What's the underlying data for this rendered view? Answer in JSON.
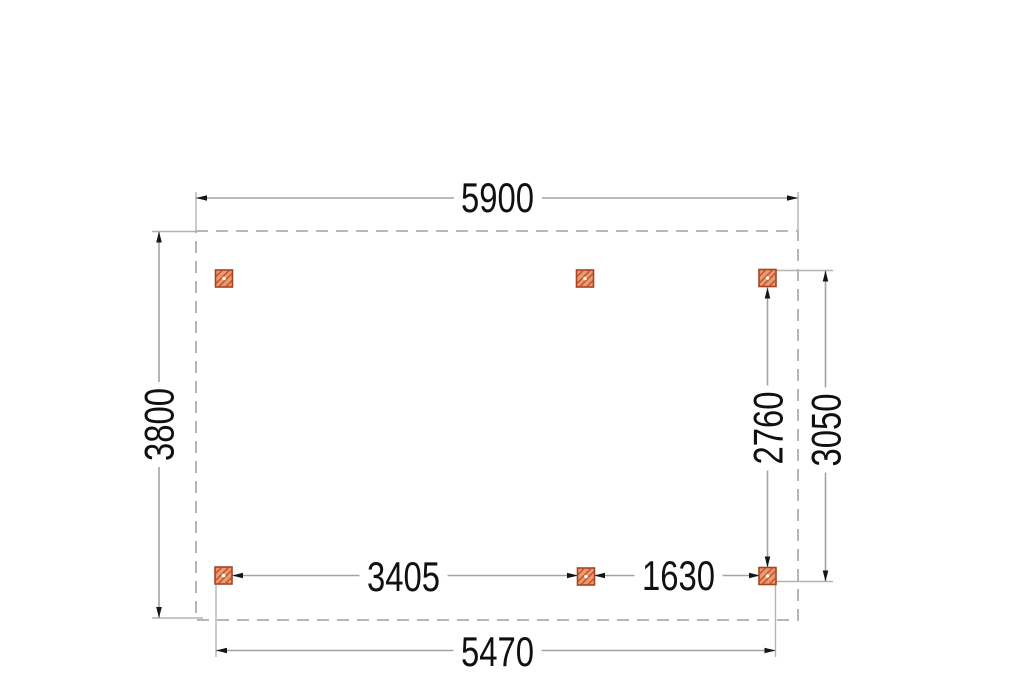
{
  "drawing": {
    "type": "floor-plan-top-view",
    "units_shown": "none",
    "posts": {
      "count": 6,
      "symbol": "hatched-square-post"
    }
  },
  "dims": {
    "overall_width": "5900",
    "overall_depth": "3800",
    "posts_clear_depth": "2760",
    "posts_outer_depth": "3050",
    "span_left": "3405",
    "span_right": "1630",
    "posts_outer_width": "5470"
  },
  "colors": {
    "background": "#ffffff",
    "dashed_outline": "#b7b7b7",
    "dimension_line": "#a3a3a3",
    "extension_line": "#b3b3b3",
    "arrow": "#161616",
    "text": "#101010",
    "post_fill": "#eb9a6f",
    "post_hatch": "#c0522d",
    "post_stroke": "#a34426"
  }
}
